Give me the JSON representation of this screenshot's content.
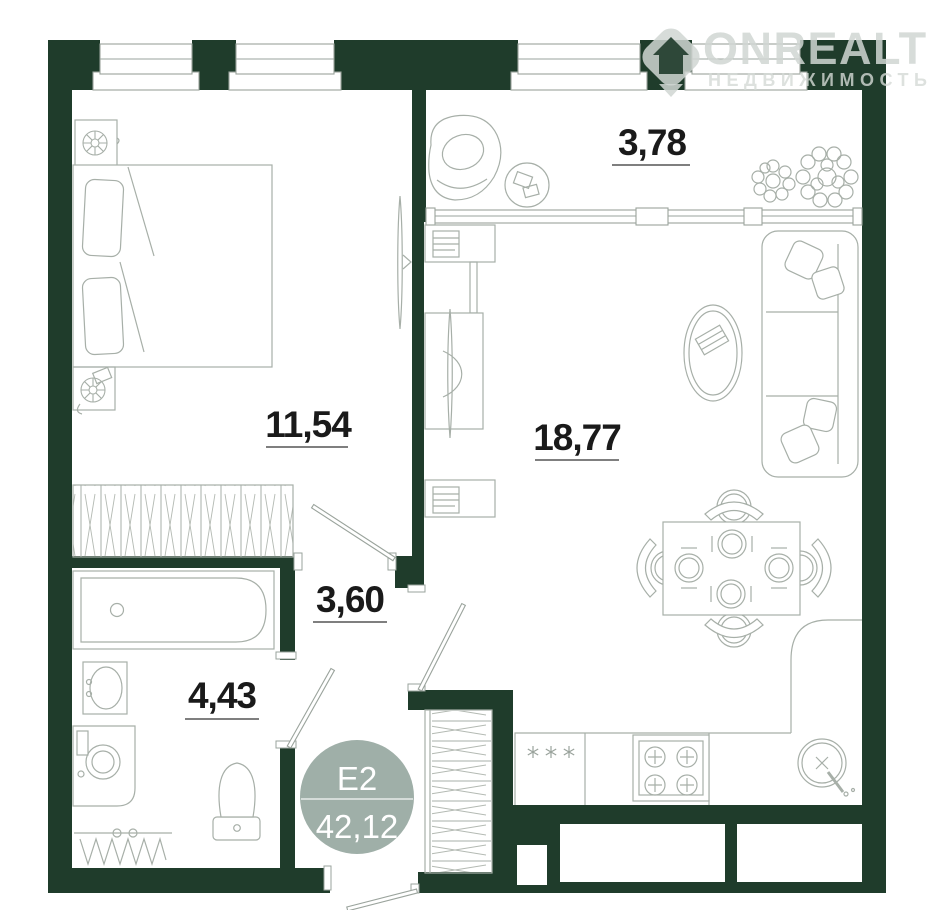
{
  "watermark": {
    "brand": "ONREALT",
    "tagline": "НЕДВИЖИМОСТЬ"
  },
  "badge": {
    "plan_type": "E2",
    "total_area": "42,12"
  },
  "rooms": {
    "balcony": {
      "area": "3,78"
    },
    "bedroom": {
      "area": "11,54"
    },
    "living": {
      "area": "18,77"
    },
    "hallway": {
      "area": "3,60"
    },
    "bathroom": {
      "area": "4,43"
    }
  },
  "colors": {
    "wall": "#1f3c2b",
    "furniture_line": "#a7afa8",
    "label_text": "#1a1a1a",
    "badge_fill": "#9fafa8",
    "badge_text": "#ffffff",
    "background": "#ffffff"
  }
}
